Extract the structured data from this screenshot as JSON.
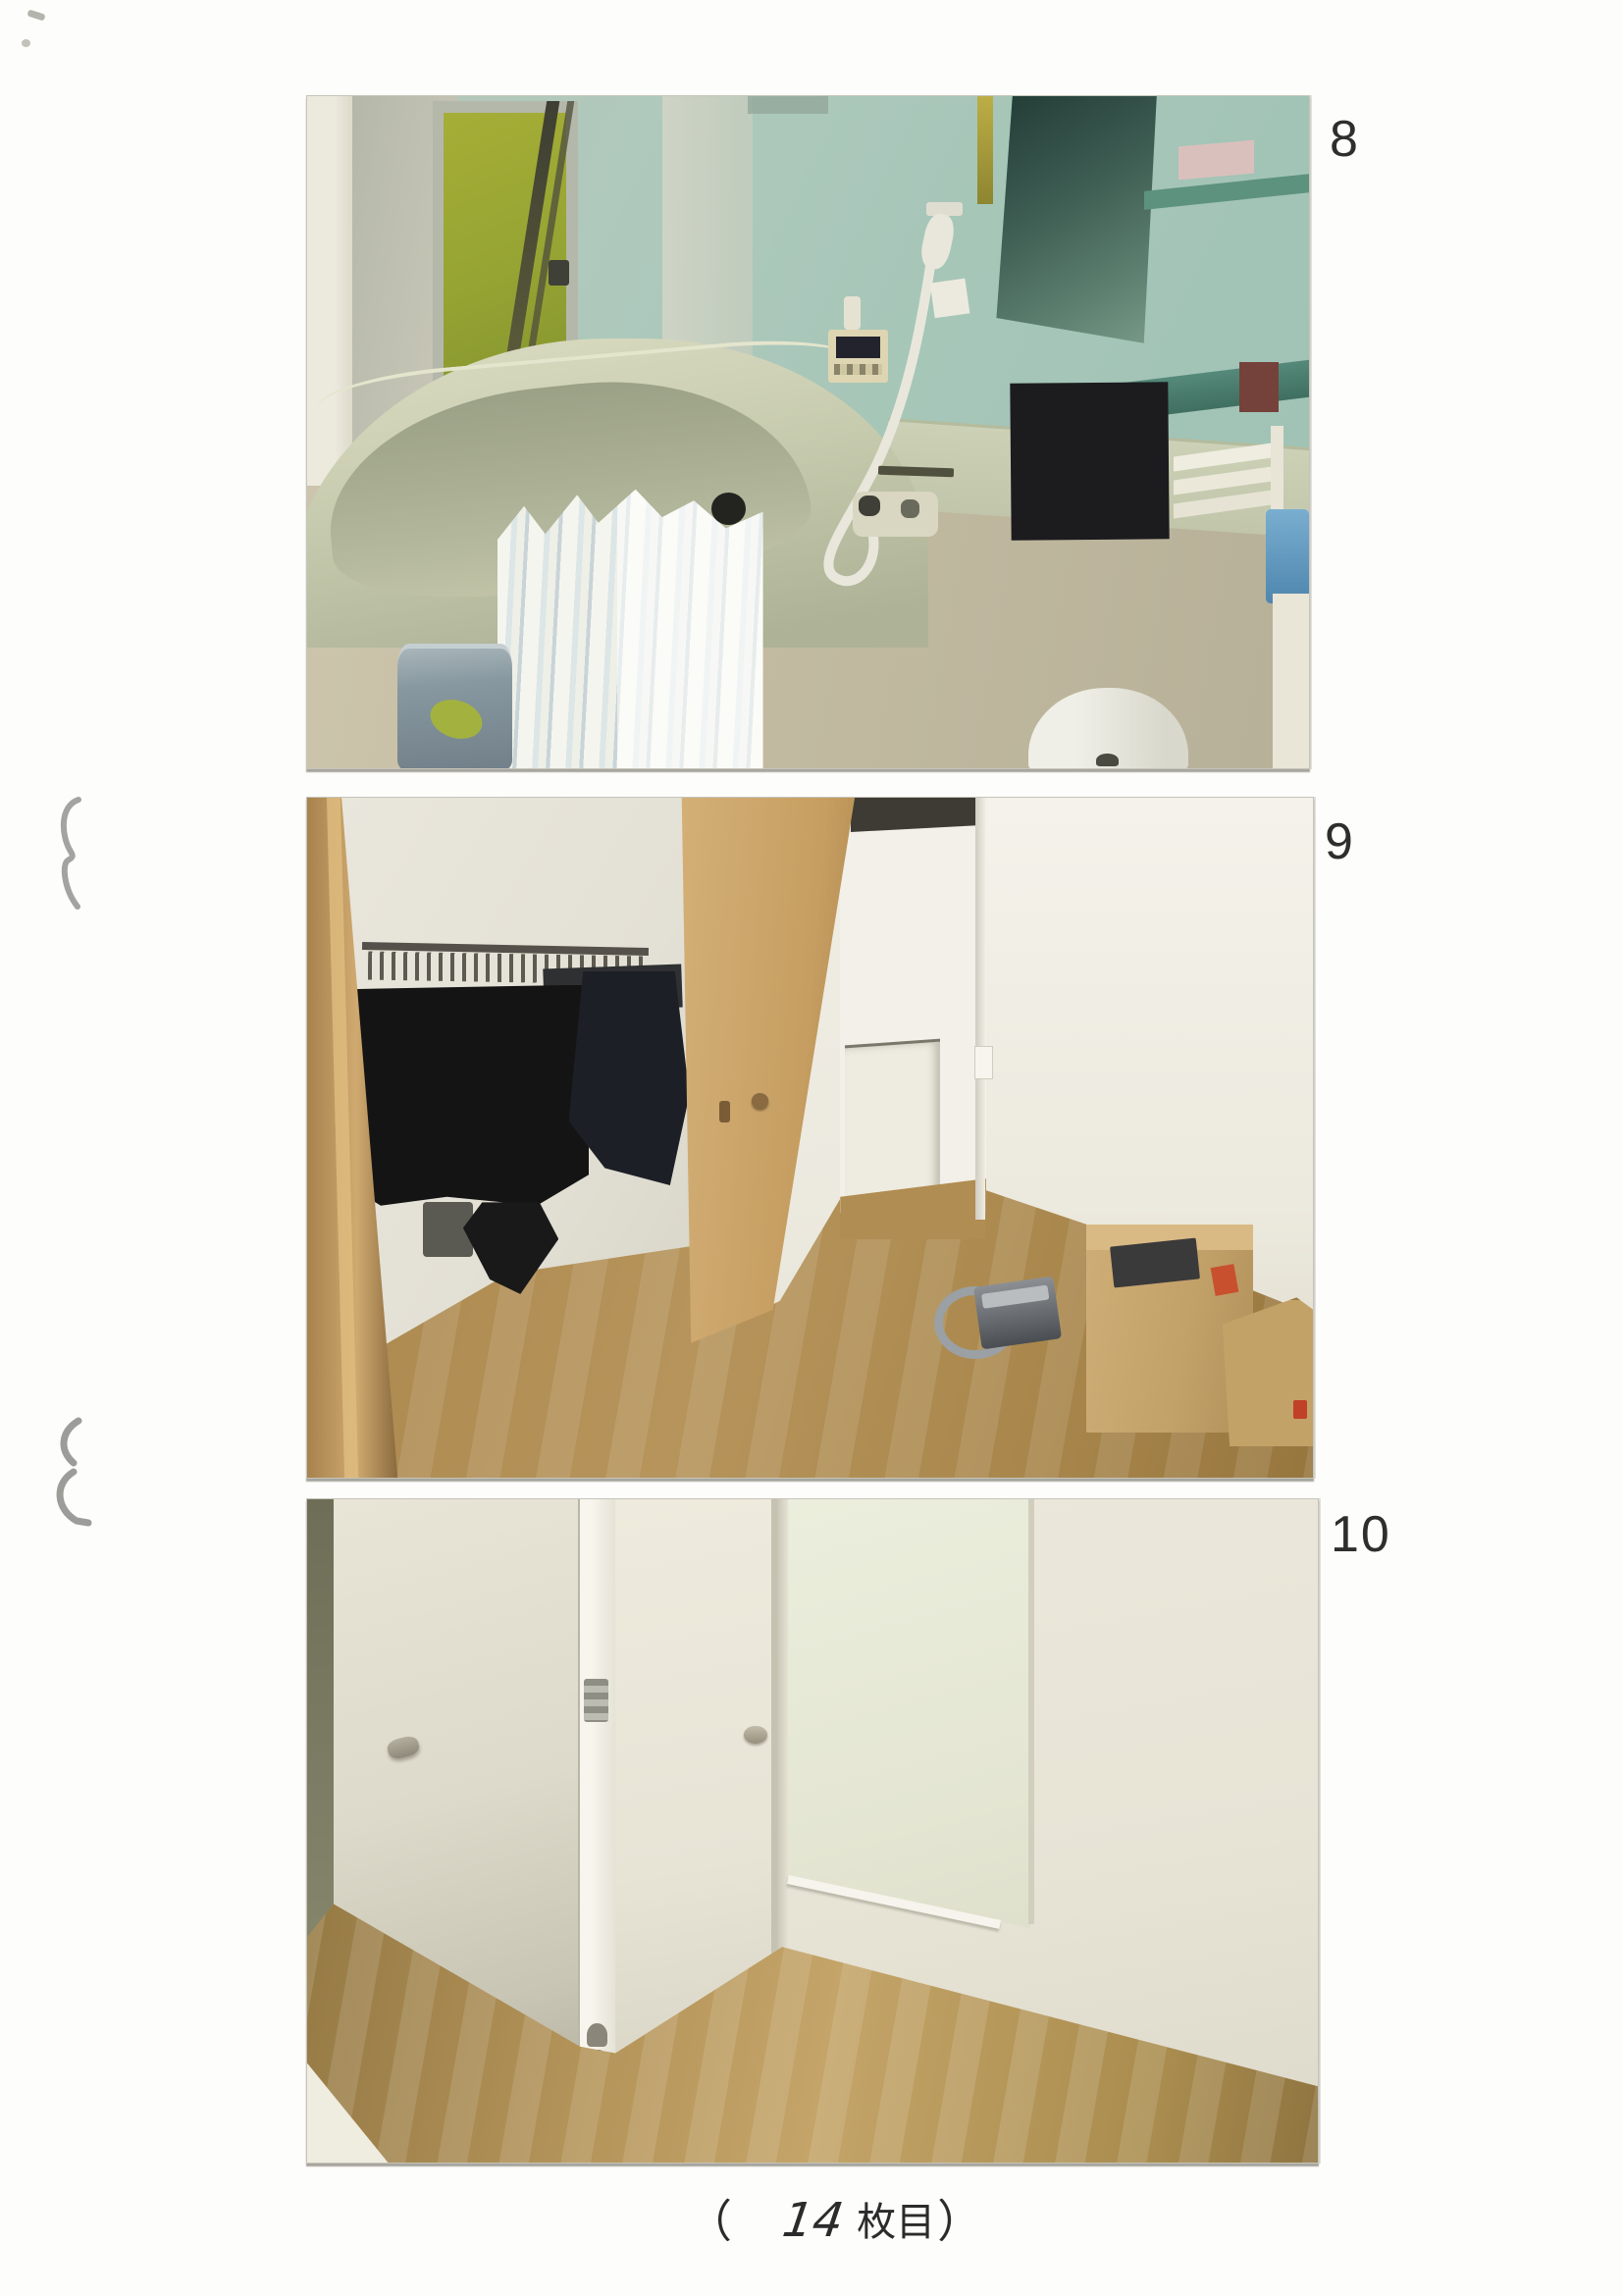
{
  "page": {
    "caption": {
      "prefix": "（",
      "number": "14",
      "label": "枚目",
      "suffix": "）"
    }
  },
  "photos": [
    {
      "label": "8",
      "subject": "bathroom with mint tiled walls, bathtub, shower hose and redacted panel"
    },
    {
      "label": "9",
      "subject": "room with open closet of dark clothes, wooden door, boxes and vacuum"
    },
    {
      "label": "10",
      "subject": "corner with white doors and wooden floor"
    }
  ],
  "colors": {
    "ink": "#2e2e2e",
    "margin_marks": "#a0a09c",
    "redaction": "#1d1d20"
  }
}
